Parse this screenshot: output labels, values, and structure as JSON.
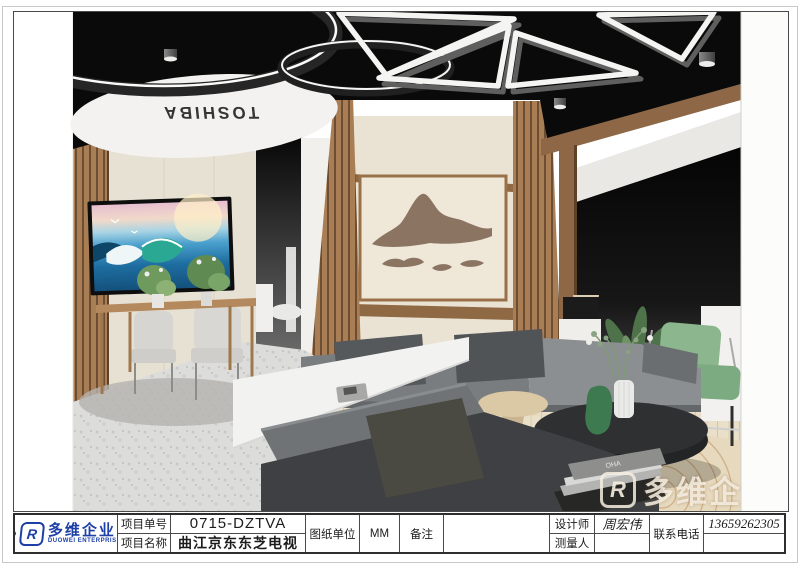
{
  "sheet": {
    "render": {
      "ceiling_brand": "TOSHIBA",
      "book_label": "OHA",
      "watermark": {
        "mark": "R",
        "text": "多维企"
      }
    },
    "title_block": {
      "logo": {
        "mark": "R",
        "name_cn": "多维企业",
        "name_en": "DUOWEI ENTERPRISE"
      },
      "project_no_label": "项目单号",
      "project_no": "0715-DZTVA",
      "project_name_label": "项目名称",
      "project_name": "曲江京东东芝电视",
      "unit_label": "图纸单位",
      "unit_value": "MM",
      "remark_label": "备注",
      "remark_value": "",
      "designer_label": "设计师",
      "designer_value": "周宏伟",
      "surveyor_label": "测量人",
      "surveyor_value": "",
      "phone_label": "联系电话",
      "phone_value": "13659262305"
    },
    "colors": {
      "brand_blue": "#1d3fa6",
      "ceiling_black": "#0a0a0a",
      "wood": "#a87c54",
      "cream_wall": "#e8e1d3",
      "sofa_gray": "#55585a",
      "chair_green": "#85b089",
      "disc_white": "#f4f3f1"
    }
  }
}
